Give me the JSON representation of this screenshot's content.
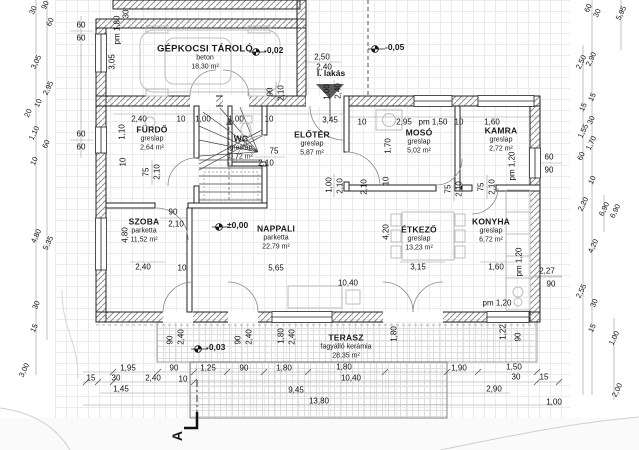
{
  "rooms": [
    {
      "id": "garage",
      "name": "GÉPKOCSI TÁROLÓ",
      "finish": "beton",
      "area": "18,30 m²"
    },
    {
      "id": "furdo",
      "name": "FÜRDŐ",
      "finish": "greslap",
      "area": "2,64 m²"
    },
    {
      "id": "wc",
      "name": "WC",
      "finish": "greslap",
      "area": "0,72 m²"
    },
    {
      "id": "eloter",
      "name": "ELŐTÉR",
      "finish": "greslap",
      "area": "5,87 m²"
    },
    {
      "id": "moso",
      "name": "MOSÓ",
      "finish": "greslap",
      "area": "5,02 m²"
    },
    {
      "id": "kamra",
      "name": "KAMRA",
      "finish": "greslap",
      "area": "2,72 m²"
    },
    {
      "id": "szoba",
      "name": "SZOBA",
      "finish": "parketta",
      "area": "11,52 m²"
    },
    {
      "id": "nappali",
      "name": "NAPPALI",
      "finish": "parketta",
      "area": "22,79 m²"
    },
    {
      "id": "etkezo",
      "name": "ÉTKEZŐ",
      "finish": "greslap",
      "area": "13,23 m²"
    },
    {
      "id": "konyha",
      "name": "KONYHA",
      "finish": "greslap",
      "area": "6,72 m²"
    },
    {
      "id": "terasz",
      "name": "TERASZ",
      "finish": "fagyálló kerámia",
      "area": "28,35 m²"
    }
  ],
  "levels": [
    {
      "label": "-0,02"
    },
    {
      "label": "-0,05"
    },
    {
      "label": "±0,00"
    },
    {
      "label": "-0,03"
    }
  ],
  "labels": {
    "dwelling": "I. lakás",
    "section_mark": "A"
  },
  "dims": [
    "30",
    "90",
    "60",
    "3,05",
    "2,95",
    "10",
    "20",
    "1,10",
    "60",
    "10",
    "4,80",
    "5,35",
    "30",
    "15",
    "3,00",
    "60",
    "60",
    "60",
    "60",
    "30",
    "pm 1,80",
    "3,05",
    "90",
    "2,10",
    "2,50",
    "2,40",
    "1,00",
    "2,40",
    "2,40",
    "10",
    "1,00",
    "1,00",
    "10",
    "3,45",
    "10",
    "2,95",
    "pm 1,50",
    "10",
    "1,60",
    "1,10",
    "10",
    "75",
    "2,10",
    "75",
    "2,10",
    "1,00",
    "2,10",
    "1,70",
    "10",
    "2,10",
    "75",
    "2,10",
    "75",
    "2,10",
    "pm 1,20",
    "60",
    "90",
    "90",
    "2,10",
    "4,80",
    "2,40",
    "10",
    "5,65",
    "4,20",
    "3,15",
    "1,60",
    "pm 1,20",
    "2,27",
    "90",
    "10,40",
    "pm 1,20",
    "1,22",
    "90",
    "90",
    "2,40",
    "90",
    "2,40",
    "1,80",
    "2,40",
    "1,80",
    "1,95",
    "90",
    "1,25",
    "90",
    "1,80",
    "1,80",
    "1,90",
    "1,50",
    "15",
    "30",
    "2,40",
    "10",
    "10,40",
    "30",
    "15",
    "1,45",
    "9,45",
    "2,90",
    "13,80",
    "1,00",
    "60",
    "30",
    "5,95",
    "2,50",
    "2,90",
    "15",
    "15",
    "30",
    "1,55",
    "1,70",
    "60",
    "10",
    "2,20",
    "6,90",
    "6,90",
    "4,20",
    "2,55",
    "30",
    "15",
    "1,00",
    "2,00"
  ]
}
